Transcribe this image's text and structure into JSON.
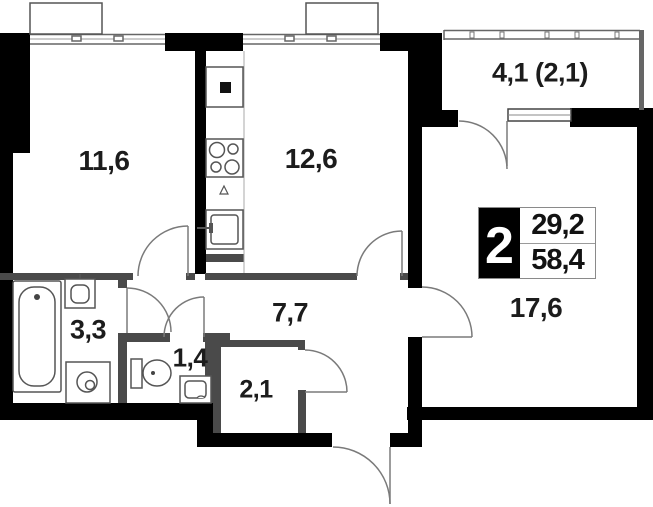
{
  "plan": {
    "title": "2-room apartment floor plan",
    "background": "#ffffff",
    "wall_color": "#000000",
    "interior_wall_color": "#4a4a4a",
    "line_color": "#777777",
    "text_color": "#1c1c1c",
    "rooms": [
      {
        "id": "room-11-6",
        "area": "11,6"
      },
      {
        "id": "kitchen-12-6",
        "area": "12,6"
      },
      {
        "id": "loggia-4-1",
        "area": "4,1 (2,1)"
      },
      {
        "id": "living-17-6",
        "area": "17,6"
      },
      {
        "id": "hall-7-7",
        "area": "7,7"
      },
      {
        "id": "bathroom-3-3",
        "area": "3,3"
      },
      {
        "id": "wc-1-4",
        "area": "1,4"
      },
      {
        "id": "storage-2-1",
        "area": "2,1"
      }
    ],
    "badge": {
      "rooms": "2",
      "living_area": "29,2",
      "total_area": "58,4"
    }
  }
}
